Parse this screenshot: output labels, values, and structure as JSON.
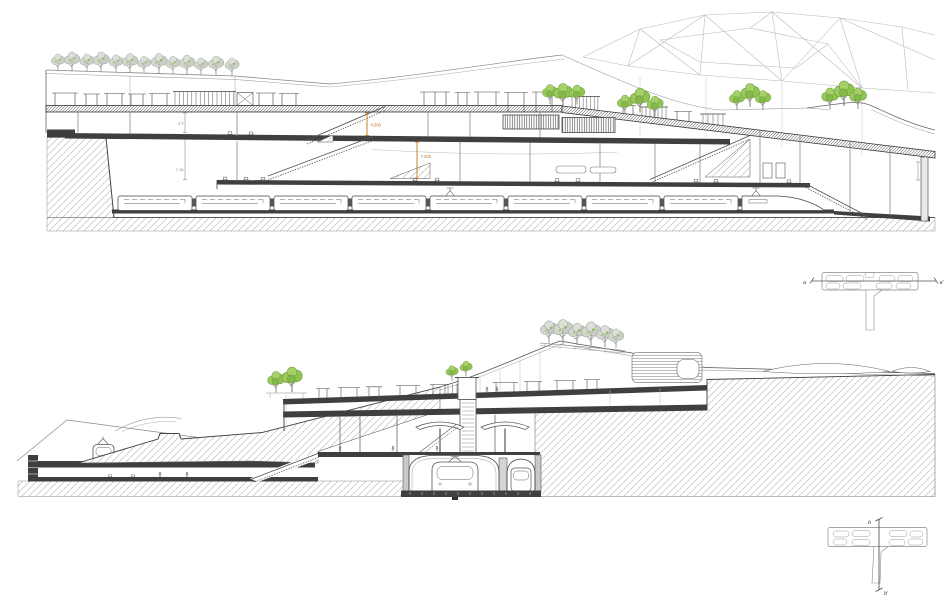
{
  "document": {
    "type": "architectural-section-drawings",
    "background": "#ffffff",
    "drawing_count": 2
  },
  "section_aa": {
    "annotations": {
      "dim_upper": "3.5",
      "dim_lower": "7.15",
      "elev_a": "4.500",
      "elev_b": "7.200"
    }
  },
  "key_plan_aa": {
    "cut_label_start": "a",
    "cut_label_end": "a'"
  },
  "key_plan_bb": {
    "cut_label_start": "b",
    "cut_label_end": "b'"
  },
  "palette": {
    "line": "#666666",
    "slab_dark": "#3f3f3f",
    "hatch_line": "#adadad",
    "tree_green": "#8fc352",
    "tree_gray": "#d2d6cf",
    "accent_orange": "#c07818"
  }
}
